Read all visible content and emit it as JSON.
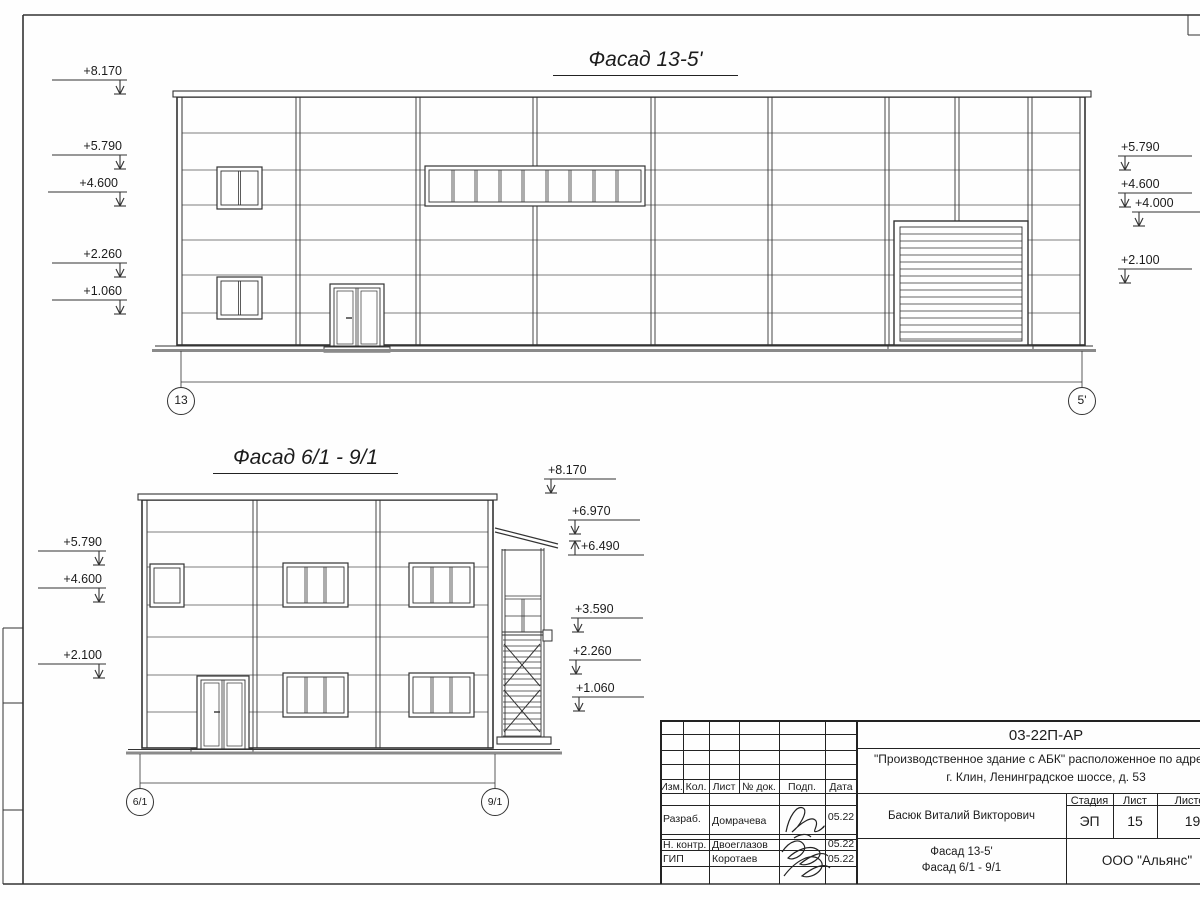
{
  "facades": {
    "f1": {
      "title": "Фасад 13-5'",
      "axis_left": "13",
      "axis_right": "5'",
      "marks_left": [
        "+8.170",
        "+5.790",
        "+4.600",
        "+2.260",
        "+1.060"
      ],
      "marks_right": [
        "+5.790",
        "+4.600",
        "+4.000",
        "+2.100"
      ]
    },
    "f2": {
      "title": "Фасад 6/1 - 9/1",
      "axis_left": "6/1",
      "axis_right": "9/1",
      "marks_left": [
        "+5.790",
        "+4.600",
        "+2.100"
      ],
      "marks_right": [
        "+8.170",
        "+6.970",
        "+6.490",
        "+3.590",
        "+2.260",
        "+1.060"
      ]
    }
  },
  "titleblock": {
    "doc_code": "03-22П-АР",
    "project_line1": "\"Производственное здание с АБК\" расположенное по адресу:",
    "project_line2": "г. Клин, Ленинградское шоссе, д. 53",
    "cols": {
      "izm": "Изм.",
      "kol": "Кол.",
      "list": "Лист",
      "ndok": "№ док.",
      "podp": "Подп.",
      "data": "Дата"
    },
    "staff": [
      {
        "role": "Разраб.",
        "name": "Домрачева",
        "date": "05.22"
      },
      {
        "role": "Н. контр.",
        "name": "Двоеглазов",
        "date": "05.22"
      },
      {
        "role": "ГИП",
        "name": "Коротаев",
        "date": "05.22"
      }
    ],
    "client": "Басюк Виталий Викторович",
    "stage_label": "Стадия",
    "sheet_label": "Лист",
    "sheets_label": "Листов",
    "stage": "ЭП",
    "sheet_no": "15",
    "sheets_total": "19",
    "drawing_title_line1": "Фасад 13-5'",
    "drawing_title_line2": "Фасад 6/1 - 9/1",
    "company": "ООО \"Альянс\""
  }
}
